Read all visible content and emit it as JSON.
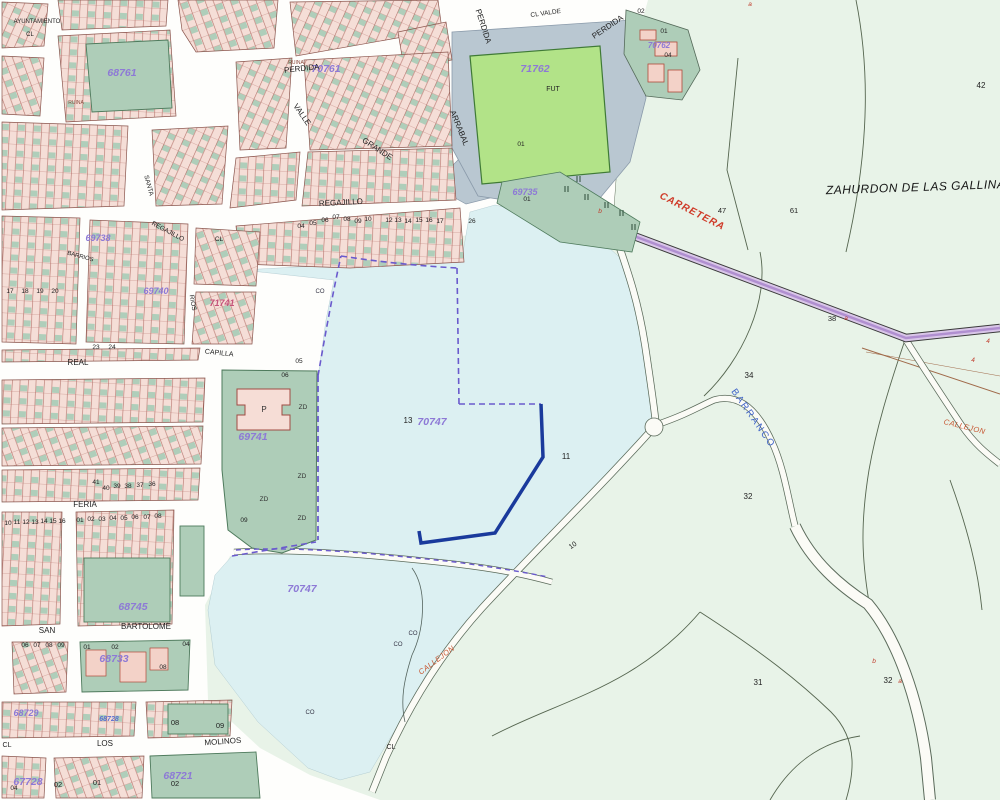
{
  "map": {
    "parcel_labels": [
      {
        "text": "68761",
        "x": 122,
        "y": 76
      },
      {
        "text": "70761",
        "x": 326,
        "y": 72
      },
      {
        "text": "71762",
        "x": 535,
        "y": 72
      },
      {
        "text": "70762",
        "x": 659,
        "y": 48,
        "size": 8
      },
      {
        "text": "69735",
        "x": 525,
        "y": 195,
        "size": 9
      },
      {
        "text": "69738",
        "x": 98,
        "y": 241,
        "size": 9
      },
      {
        "text": "69740",
        "x": 156,
        "y": 294,
        "size": 9
      },
      {
        "text": "71741",
        "x": 222,
        "y": 306,
        "cls": "lp-red"
      },
      {
        "text": "69741",
        "x": 253,
        "y": 440
      },
      {
        "text": "70747",
        "x": 432,
        "y": 425
      },
      {
        "text": "70747",
        "x": 302,
        "y": 592
      },
      {
        "text": "68745",
        "x": 133,
        "y": 610
      },
      {
        "text": "68733",
        "x": 114,
        "y": 662
      },
      {
        "text": "68729",
        "x": 26,
        "y": 716,
        "size": 9
      },
      {
        "text": "68728",
        "x": 109,
        "y": 721,
        "cls": "lp-blue"
      },
      {
        "text": "67728",
        "x": 28,
        "y": 785
      },
      {
        "text": "68721",
        "x": 178,
        "y": 779
      }
    ],
    "street_labels": [
      {
        "text": "AYUNTAMIENTO",
        "x": 37,
        "y": 23,
        "size": 6
      },
      {
        "text": "CL",
        "x": 30,
        "y": 36,
        "size": 6
      },
      {
        "text": "PERDIDA",
        "x": 302,
        "y": 71,
        "rot": -6
      },
      {
        "text": "PERDIDA",
        "x": 609,
        "y": 29,
        "rot": -34
      },
      {
        "text": "PERDIDA",
        "x": 481,
        "y": 27,
        "rot": 72
      },
      {
        "text": "CL VALDE",
        "x": 546,
        "y": 15,
        "rot": -8,
        "size": 6.5
      },
      {
        "text": "ARRABAL",
        "x": 457,
        "y": 129,
        "rot": 68
      },
      {
        "text": "GRANDE",
        "x": 376,
        "y": 151,
        "rot": 33
      },
      {
        "text": "VALLE",
        "x": 300,
        "y": 116,
        "rot": 55
      },
      {
        "text": "REGAJILLO",
        "x": 341,
        "y": 205,
        "rot": -3
      },
      {
        "text": "REGAJILLO",
        "x": 167,
        "y": 233,
        "rot": 28,
        "size": 6.5
      },
      {
        "text": "CL",
        "x": 219,
        "y": 241,
        "size": 6.5
      },
      {
        "text": "SANTA",
        "x": 147,
        "y": 186,
        "rot": 75,
        "size": 6.5
      },
      {
        "text": "BARRIOS",
        "x": 80,
        "y": 258,
        "rot": 15,
        "size": 6
      },
      {
        "text": "RIOS",
        "x": 191,
        "y": 303,
        "rot": 80,
        "size": 6.5
      },
      {
        "text": "REAL",
        "x": 78,
        "y": 365
      },
      {
        "text": "CAPILLA",
        "x": 219,
        "y": 355,
        "rot": 6,
        "size": 7
      },
      {
        "text": "FERIA",
        "x": 85,
        "y": 507
      },
      {
        "text": "SAN",
        "x": 47,
        "y": 633
      },
      {
        "text": "BARTOLOME",
        "x": 146,
        "y": 629
      },
      {
        "text": "CL",
        "x": 7,
        "y": 747,
        "size": 7
      },
      {
        "text": "LOS",
        "x": 105,
        "y": 746
      },
      {
        "text": "MOLINOS",
        "x": 223,
        "y": 744,
        "rot": -4
      },
      {
        "text": "CL",
        "x": 391,
        "y": 749,
        "size": 7
      }
    ],
    "area_labels": [
      {
        "text": "ZAHURDON DE LAS GALLINAS",
        "x": 920,
        "y": 191,
        "rot": -2,
        "cls": "zah"
      },
      {
        "text": "CARRETERA",
        "x": 691,
        "y": 214,
        "rot": 27,
        "cls": "carr"
      },
      {
        "text": "BARRANCO",
        "x": 751,
        "y": 420,
        "rot": 55,
        "cls": "barr"
      },
      {
        "text": "CALLEJON",
        "x": 438,
        "y": 662,
        "rot": -37,
        "cls": "call"
      },
      {
        "text": "CALLEJON",
        "x": 964,
        "y": 429,
        "rot": 14,
        "cls": "call"
      }
    ],
    "small_numbers": [
      {
        "text": "42",
        "x": 981,
        "y": 88,
        "size": 8
      },
      {
        "text": "47",
        "x": 722,
        "y": 213,
        "size": 7.5
      },
      {
        "text": "61",
        "x": 794,
        "y": 213,
        "size": 7.5
      },
      {
        "text": "38",
        "x": 832,
        "y": 321,
        "size": 7.5
      },
      {
        "text": "34",
        "x": 749,
        "y": 378,
        "size": 8
      },
      {
        "text": "32",
        "x": 748,
        "y": 499,
        "size": 8
      },
      {
        "text": "31",
        "x": 758,
        "y": 685,
        "size": 8
      },
      {
        "text": "32",
        "x": 888,
        "y": 683,
        "size": 8
      },
      {
        "text": "11",
        "x": 566,
        "y": 459,
        "size": 8
      },
      {
        "text": "13",
        "x": 408,
        "y": 423,
        "size": 8
      },
      {
        "text": "10",
        "x": 574,
        "y": 547,
        "rot": -35,
        "size": 7
      },
      {
        "text": "01",
        "x": 521,
        "y": 146
      },
      {
        "text": "01",
        "x": 527,
        "y": 201
      },
      {
        "text": "02",
        "x": 641,
        "y": 13
      },
      {
        "text": "01",
        "x": 664,
        "y": 33
      },
      {
        "text": "04",
        "x": 668,
        "y": 57
      },
      {
        "text": "04",
        "x": 301,
        "y": 228
      },
      {
        "text": "05",
        "x": 313,
        "y": 225
      },
      {
        "text": "06",
        "x": 325,
        "y": 222
      },
      {
        "text": "07",
        "x": 336,
        "y": 219
      },
      {
        "text": "08",
        "x": 347,
        "y": 221
      },
      {
        "text": "09",
        "x": 358,
        "y": 223
      },
      {
        "text": "10",
        "x": 368,
        "y": 221
      },
      {
        "text": "12",
        "x": 389,
        "y": 222
      },
      {
        "text": "13",
        "x": 398,
        "y": 222
      },
      {
        "text": "14",
        "x": 408,
        "y": 223
      },
      {
        "text": "15",
        "x": 419,
        "y": 222
      },
      {
        "text": "16",
        "x": 429,
        "y": 222
      },
      {
        "text": "17",
        "x": 440,
        "y": 223
      },
      {
        "text": "26",
        "x": 472,
        "y": 223
      },
      {
        "text": "05",
        "x": 299,
        "y": 363
      },
      {
        "text": "06",
        "x": 285,
        "y": 377
      },
      {
        "text": "09",
        "x": 244,
        "y": 522
      },
      {
        "text": "23",
        "x": 96,
        "y": 349
      },
      {
        "text": "24",
        "x": 112,
        "y": 349
      },
      {
        "text": "17",
        "x": 10,
        "y": 293
      },
      {
        "text": "18",
        "x": 25,
        "y": 293
      },
      {
        "text": "19",
        "x": 40,
        "y": 293
      },
      {
        "text": "20",
        "x": 55,
        "y": 293
      },
      {
        "text": "41",
        "x": 96,
        "y": 484
      },
      {
        "text": "40",
        "x": 106,
        "y": 490
      },
      {
        "text": "39",
        "x": 117,
        "y": 488
      },
      {
        "text": "38",
        "x": 128,
        "y": 488
      },
      {
        "text": "37",
        "x": 140,
        "y": 487
      },
      {
        "text": "36",
        "x": 152,
        "y": 486
      },
      {
        "text": "01",
        "x": 80,
        "y": 522
      },
      {
        "text": "02",
        "x": 91,
        "y": 521
      },
      {
        "text": "03",
        "x": 102,
        "y": 521
      },
      {
        "text": "04",
        "x": 113,
        "y": 520
      },
      {
        "text": "05",
        "x": 124,
        "y": 520
      },
      {
        "text": "06",
        "x": 135,
        "y": 519
      },
      {
        "text": "07",
        "x": 147,
        "y": 519
      },
      {
        "text": "08",
        "x": 158,
        "y": 518
      },
      {
        "text": "10",
        "x": 8,
        "y": 525
      },
      {
        "text": "11",
        "x": 17,
        "y": 524
      },
      {
        "text": "12",
        "x": 26,
        "y": 524
      },
      {
        "text": "13",
        "x": 35,
        "y": 524
      },
      {
        "text": "14",
        "x": 44,
        "y": 523
      },
      {
        "text": "15",
        "x": 53,
        "y": 523
      },
      {
        "text": "16",
        "x": 62,
        "y": 523
      },
      {
        "text": "01",
        "x": 87,
        "y": 649
      },
      {
        "text": "02",
        "x": 115,
        "y": 649
      },
      {
        "text": "04",
        "x": 186,
        "y": 646
      },
      {
        "text": "08",
        "x": 163,
        "y": 669
      },
      {
        "text": "06",
        "x": 25,
        "y": 647
      },
      {
        "text": "07",
        "x": 37,
        "y": 647
      },
      {
        "text": "08",
        "x": 49,
        "y": 647
      },
      {
        "text": "09",
        "x": 61,
        "y": 647
      },
      {
        "text": "08",
        "x": 175,
        "y": 725,
        "size": 7.5
      },
      {
        "text": "09",
        "x": 220,
        "y": 728,
        "size": 7.5
      },
      {
        "text": "01",
        "x": 97,
        "y": 785,
        "size": 7.5
      },
      {
        "text": "02",
        "x": 58,
        "y": 787,
        "size": 7.5
      },
      {
        "text": "02",
        "x": 175,
        "y": 786,
        "size": 7.5
      },
      {
        "text": "04",
        "x": 14,
        "y": 790
      }
    ],
    "marks": [
      {
        "text": "a",
        "x": 846,
        "y": 320,
        "cls": "redmark"
      },
      {
        "text": "a",
        "x": 900,
        "y": 683,
        "cls": "redmark"
      },
      {
        "text": "b",
        "x": 874,
        "y": 663,
        "cls": "redmark"
      },
      {
        "text": "4",
        "x": 988,
        "y": 343,
        "cls": "redmark"
      },
      {
        "text": "4",
        "x": 973,
        "y": 362,
        "cls": "redmark"
      },
      {
        "text": "a",
        "x": 750,
        "y": 6,
        "cls": "redmark"
      },
      {
        "text": "b",
        "x": 600,
        "y": 213,
        "cls": "redmark"
      },
      {
        "text": "ZD",
        "x": 303,
        "y": 409,
        "cls": "zd"
      },
      {
        "text": "ZD",
        "x": 302,
        "y": 478,
        "cls": "zd"
      },
      {
        "text": "ZD",
        "x": 264,
        "y": 501,
        "cls": "zd"
      },
      {
        "text": "ZD",
        "x": 302,
        "y": 520,
        "cls": "zd"
      },
      {
        "text": "CO",
        "x": 398,
        "y": 646,
        "cls": "co"
      },
      {
        "text": "CO",
        "x": 413,
        "y": 635,
        "cls": "co"
      },
      {
        "text": "CO",
        "x": 310,
        "y": 714,
        "cls": "co"
      },
      {
        "text": "CO",
        "x": 320,
        "y": 293,
        "cls": "co"
      },
      {
        "text": "FUT",
        "x": 553,
        "y": 91,
        "cls": "fut"
      },
      {
        "text": "P",
        "x": 264,
        "y": 412,
        "cls": "pbld"
      },
      {
        "text": "RUINA",
        "x": 296,
        "y": 64,
        "cls": "ruina"
      },
      {
        "text": "RUINA",
        "x": 76,
        "y": 104,
        "cls": "ruina"
      }
    ],
    "colors": {
      "countryside": "#e8f3e8",
      "parcel_cyan": "#dcf0f2",
      "urban_pink": "#f5ded7",
      "urban_green": "#aecdb8",
      "pitch_green": "#b2e388",
      "band_gray": "#b9c7d1",
      "parcel_label_purple": "#8d79d6",
      "carretera_red": "#cf3a28",
      "barranco_blue": "#3f63c8",
      "navy_boundary": "#1a3a9c",
      "dashed_boundary": "#6a5acd",
      "road_lavender": "#d9c6e8"
    }
  }
}
